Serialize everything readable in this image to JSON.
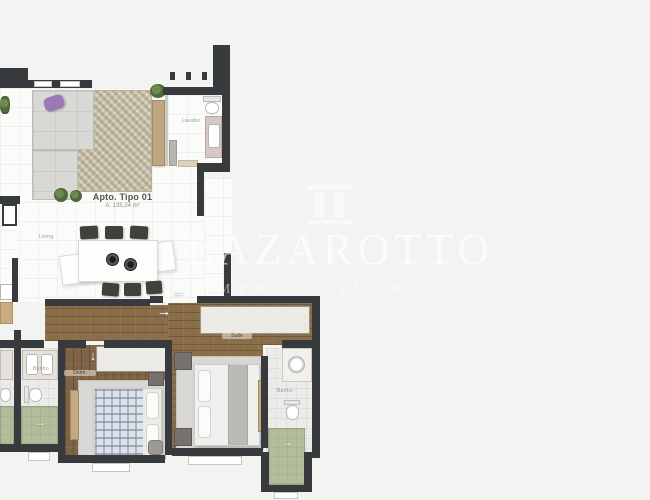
{
  "watermark": {
    "brand": "LAZAROTTO",
    "subtitle": "EMPREENDIMENTOS",
    "logo": "column-arch-icon"
  },
  "apartment": {
    "title": "Apto. Tipo 01",
    "area": "A: 135,24 m²"
  },
  "rooms": {
    "living": "Living",
    "lavabo": "Lavabo",
    "suite": "Suíte",
    "bedroom": "Dorm.",
    "bath": "Banho",
    "bath_suite": "Banho"
  },
  "icons": {
    "arrow_left": "←",
    "arrow_right": "→",
    "arrow_down": "↓"
  },
  "colors": {
    "wall": "#383b3d",
    "wood": "#8a6d49",
    "shower_floor": "#b3bd9c",
    "pillow_accent": "#9a7ab6",
    "watermark": "#ffffff"
  }
}
